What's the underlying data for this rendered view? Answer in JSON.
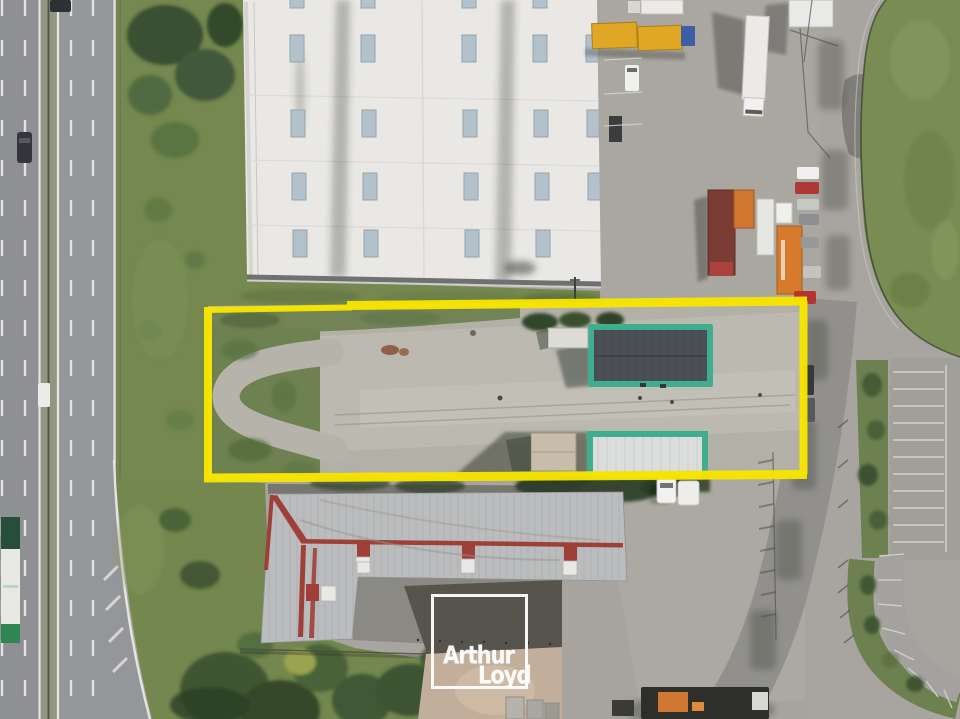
{
  "meta": {
    "kind": "aerial-photograph",
    "subject": "Aerial drone view of an industrial site with a land parcel highlighted in yellow"
  },
  "watermark": {
    "line1": "Arthur",
    "line2": "Loyd"
  },
  "colors": {
    "parcel_outline": "#f6e400",
    "building_trim_teal": "#3fae8e",
    "watermark_white": "#ffffff",
    "grass": "#74884f",
    "concrete": "#a8a5a0",
    "asphalt": "#96979a",
    "warehouse_roof": "#e9e8e4",
    "metal_roof_gray": "#bbbcbd",
    "roof_ridge_red": "#9e4038",
    "trailer_yellow": "#dfa723",
    "trailer_orange": "#d0752c",
    "trailer_maroon": "#7b3d33"
  },
  "scene": {
    "highlighted_parcel": "vacant concrete parcel outlined in yellow",
    "teal_buildings": "two green-trimmed warehouse units inside the parcel",
    "white_warehouse": "large white-roofed warehouse with skylights at top",
    "red_gray_building": "gray metal building with red ridge lines at bottom",
    "highway": "dual carriageway along the left edge",
    "truck_yard": "trucks, trailers and car parking in the logistics yard at right"
  }
}
